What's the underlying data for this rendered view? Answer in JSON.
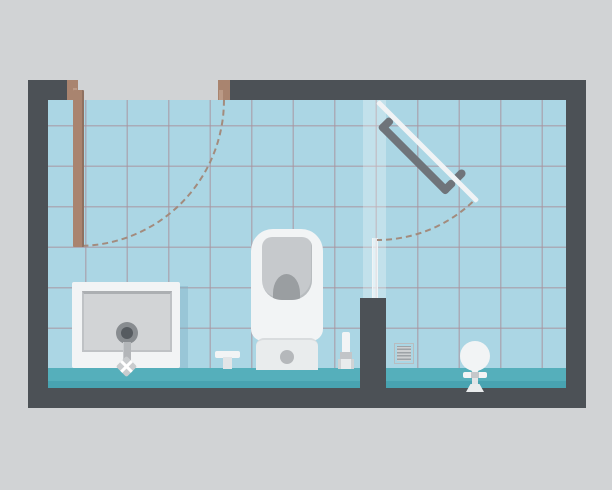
{
  "scene": {
    "label": "Flat-style illustration of a bathroom interior floor plan with tiled walls, entry door with swing arc, shower tray, toilet, glass shower partition and fixtures",
    "width_px": 612,
    "height_px": 490
  },
  "palette": {
    "bg": "#d1d3d5",
    "wall": "#4c5156",
    "tile": "#abd6e4",
    "grout": "#a8909b99",
    "floor": "#55afbb",
    "floor_shade": "#48a3b1",
    "wood": "#a9846f",
    "wood_light": "#bb9a86",
    "wood_dark": "#8f7161",
    "dash": "#a38b7d",
    "white": "#f2f4f5",
    "white_soft": "#e9eced",
    "panel": "#d2d4d6",
    "panel_edge": "#b7babd",
    "stem": "#b3b6b9",
    "drain_ring": "#888c90",
    "drain_core": "#565b60",
    "bowl": "#c6c9cc",
    "bowl_inner": "#9a9ea1",
    "button": "#b5b8bb",
    "glass": "#ffffff47",
    "glass_bar": "#f0f3f5",
    "handle": "#6f747a",
    "vent_bg": "#cdd0d2",
    "vent_line": "#9da2a6",
    "shadow_blue": "#7fb0c266"
  },
  "labels": {
    "scene": "bathroom floor plan illustration",
    "room": "bathroom room outline",
    "tiles": "blue tiled interior",
    "floor": "teal floor strip",
    "entry_door": "wooden entry door leaf",
    "door_swing": "entry door swing arc",
    "door_jamb_left": "left door jamb",
    "door_jamb_right": "right door jamb",
    "glass_screen": "glass shower screen",
    "glass_panel": "glass panel edge",
    "shower_door": "glass shower door with handle",
    "shower_swing": "shower door swing arc",
    "partition": "partition half wall",
    "shower_tray": "shower tray with drain and valve",
    "floor_tap": "floor-mounted tap",
    "toilet": "toilet seen from above",
    "toilet_brush": "toilet brush",
    "vent": "ventilation grille",
    "pedestal": "pedestal fixture"
  }
}
